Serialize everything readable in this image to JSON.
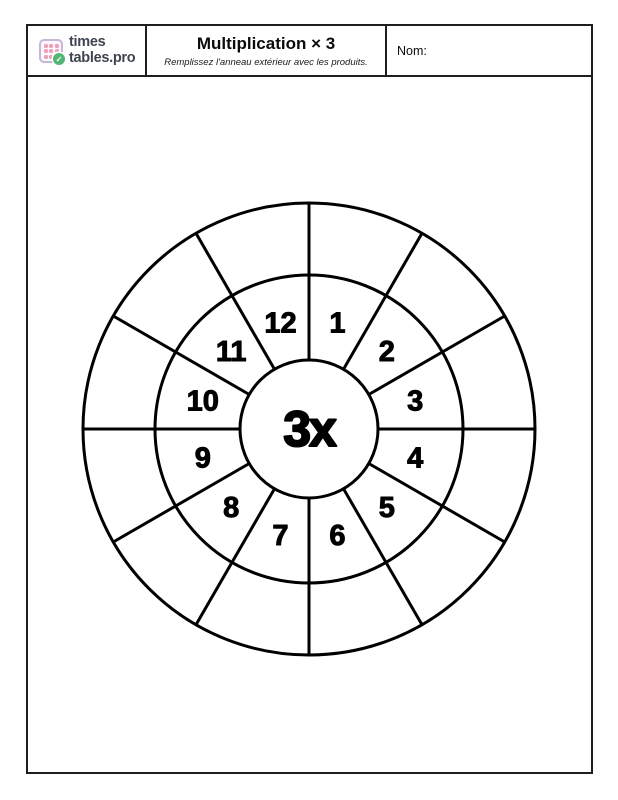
{
  "page": {
    "background": "#ffffff",
    "border_color": "#1e1e1e"
  },
  "header": {
    "logo": {
      "text_line1": "times",
      "text_line2": "tables.pro",
      "icon": {
        "name": "times-tables-grid-icon",
        "square_border_color": "#c7b6d8",
        "dot_color": "#f0a0b6",
        "check_bg_color": "#52b573",
        "check_glyph": "✓"
      }
    },
    "title": "Multiplication × 3",
    "subtitle": "Remplissez l'anneau extérieur avec les produits.",
    "name_label": "Nom:"
  },
  "wheel": {
    "center_label": "3x",
    "multiplier": 3,
    "segments": [
      "1",
      "2",
      "3",
      "4",
      "5",
      "6",
      "7",
      "8",
      "9",
      "10",
      "11",
      "12"
    ],
    "outer_values": [
      "",
      "",
      "",
      "",
      "",
      "",
      "",
      "",
      "",
      "",
      "",
      ""
    ],
    "stroke_color": "#000000"
  }
}
